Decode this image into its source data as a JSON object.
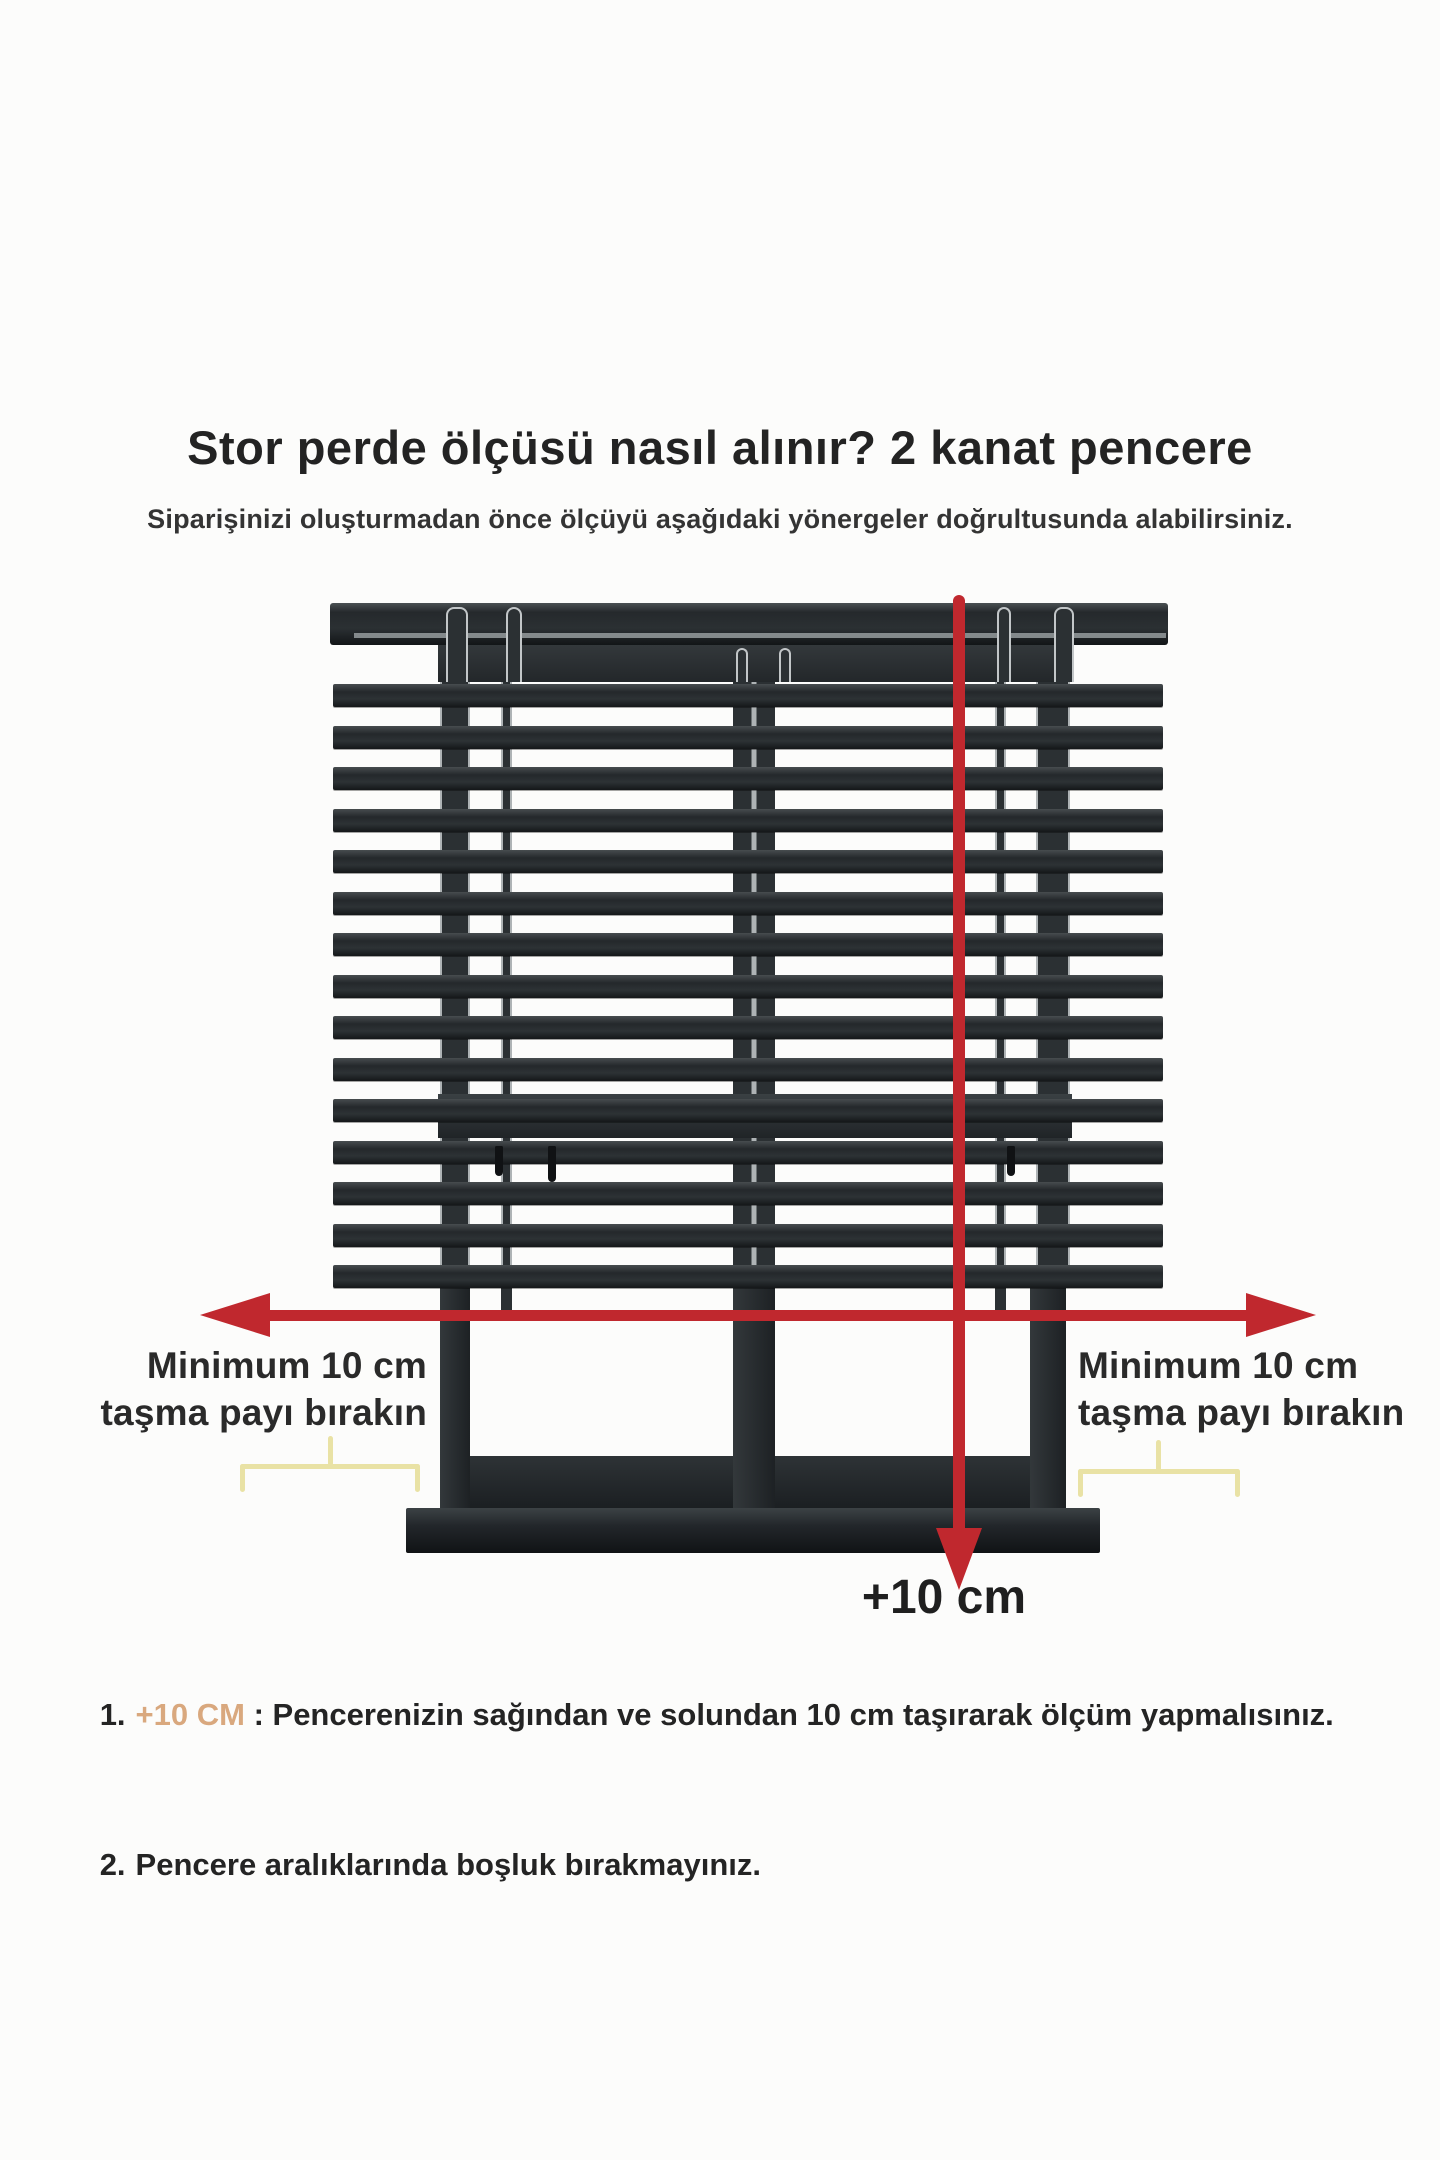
{
  "header": {
    "title": "Stor perde ölçüsü nasıl alınır? 2 kanat pencere",
    "subtitle": "Siparişinizi oluşturmadan önce ölçüyü aşağıdaki yönergeler doğrultusunda alabilirsiniz."
  },
  "diagram": {
    "colors": {
      "bg": "#fcfcfb",
      "dark": "#282c2f",
      "edge": "#aeb3b5",
      "grayline": "#959b9d",
      "red": "#c0282e",
      "yellow": "#e9e2a5",
      "tan": "#d9a87e",
      "text": "#262626"
    },
    "slats": {
      "count": 15,
      "x": 333,
      "width": 830,
      "height": 23,
      "first_top": 684,
      "pitch": 41.5
    },
    "glass_top": 682,
    "glass_bottom": 1288,
    "behind_posts": [
      {
        "x": 440,
        "w": 30,
        "split": false
      },
      {
        "x": 501,
        "w": 11,
        "split": false
      },
      {
        "x": 733,
        "w": 42,
        "split": true
      },
      {
        "x": 995,
        "w": 11,
        "split": false
      },
      {
        "x": 1036,
        "w": 34,
        "split": false
      }
    ],
    "top_posts": [
      {
        "x": 446,
        "w": 22,
        "top": 607,
        "h": 75
      },
      {
        "x": 506,
        "w": 16,
        "top": 607,
        "h": 75
      },
      {
        "x": 736,
        "w": 12,
        "top": 648,
        "h": 34
      },
      {
        "x": 779,
        "w": 12,
        "top": 648,
        "h": 34
      },
      {
        "x": 997,
        "w": 14,
        "top": 607,
        "h": 75
      },
      {
        "x": 1054,
        "w": 20,
        "top": 607,
        "h": 75
      }
    ],
    "lower_posts": [
      {
        "x": 440,
        "w": 30
      },
      {
        "x": 733,
        "w": 42
      },
      {
        "x": 1030,
        "w": 36
      }
    ],
    "stubs": [
      {
        "x": 501
      },
      {
        "x": 995
      }
    ],
    "handles": [
      {
        "x": 495,
        "y": 1146,
        "h": 30
      },
      {
        "x": 548,
        "y": 1146,
        "h": 36
      },
      {
        "x": 1007,
        "y": 1146,
        "h": 30
      }
    ]
  },
  "annotations": {
    "left_label": {
      "line1": "Minimum 10 cm",
      "line2": "taşma payı bırakın"
    },
    "right_label": {
      "line1": "Minimum 10 cm",
      "line2": "taşma payı bırakın"
    },
    "bottom_label": "+10 cm"
  },
  "instructions": [
    {
      "number": "1.",
      "highlight": "+10 CM",
      "text": " : Pencerenizin sağından ve solundan 10 cm taşırarak ölçüm yapmalısınız."
    },
    {
      "number": "2.",
      "highlight": "",
      "text": "Pencere aralıklarında boşluk bırakmayınız."
    }
  ]
}
